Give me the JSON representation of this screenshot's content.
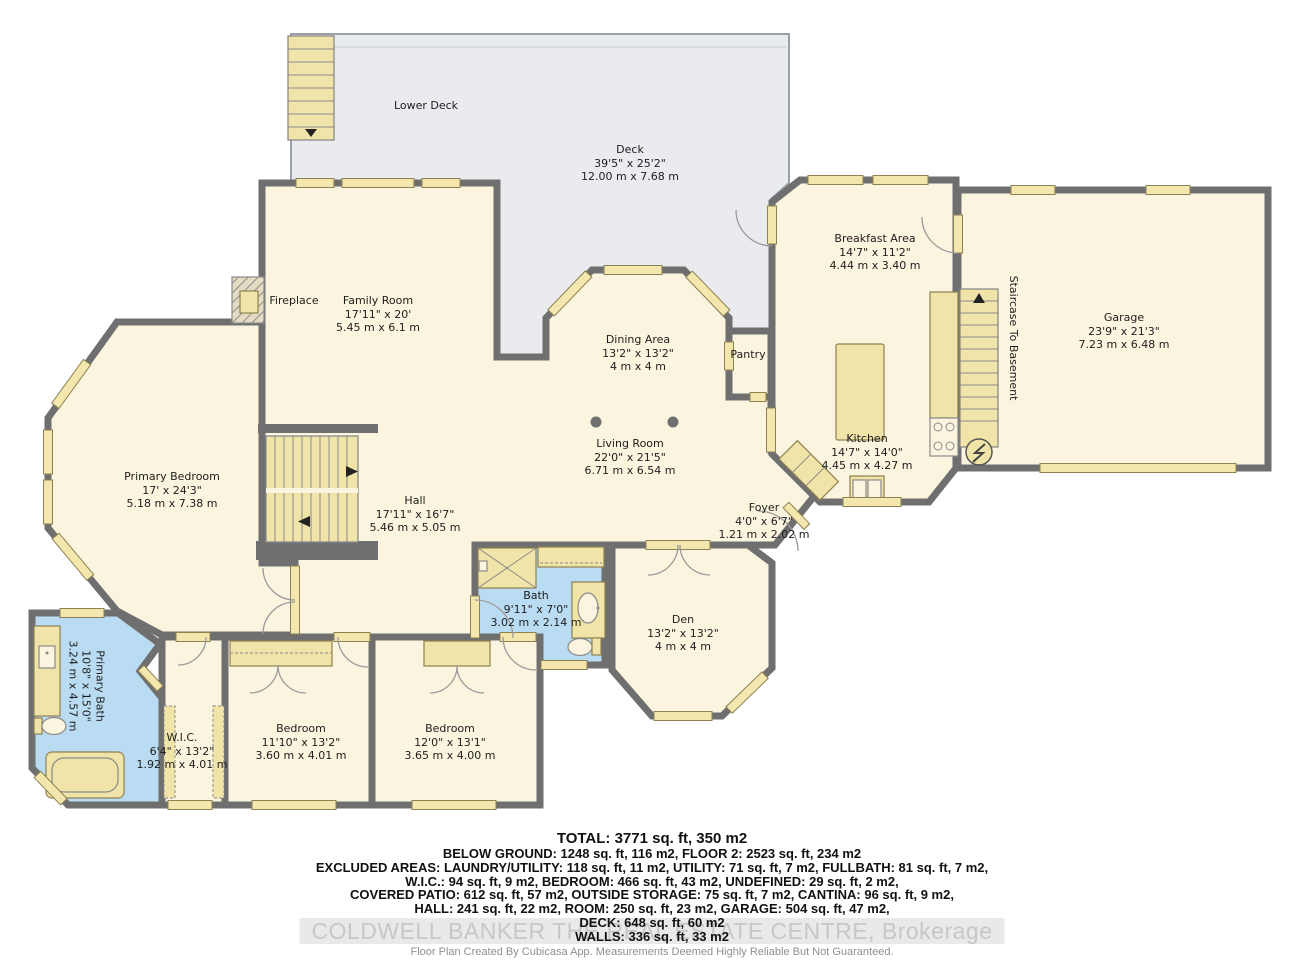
{
  "colors": {
    "wall": "#6f6f6f",
    "room_fill": "#fbf5df",
    "deck_fill": "#e9ebee",
    "bath_fill": "#badcf2",
    "fixture_fill": "#f1e4a8"
  },
  "rooms": {
    "lower_deck": {
      "name": "Lower Deck"
    },
    "deck": {
      "name": "Deck",
      "imperial": "39'5\" x 25'2\"",
      "metric": "12.00 m x 7.68 m"
    },
    "breakfast": {
      "name": "Breakfast Area",
      "imperial": "14'7\" x 11'2\"",
      "metric": "4.44 m x 3.40 m"
    },
    "garage": {
      "name": "Garage",
      "imperial": "23'9\" x 21'3\"",
      "metric": "7.23 m x 6.48 m"
    },
    "staircase_basement": {
      "name": "Staircase To Basement"
    },
    "kitchen": {
      "name": "Kitchen",
      "imperial": "14'7\" x 14'0\"",
      "metric": "4.45 m x 4.27 m"
    },
    "pantry": {
      "name": "Pantry"
    },
    "family": {
      "name": "Family Room",
      "imperial": "17'11\" x 20'",
      "metric": "5.45 m x 6.1 m"
    },
    "fireplace": {
      "name": "Fireplace"
    },
    "dining": {
      "name": "Dining Area",
      "imperial": "13'2\" x 13'2\"",
      "metric": "4 m x 4 m"
    },
    "living": {
      "name": "Living Room",
      "imperial": "22'0\" x 21'5\"",
      "metric": "6.71 m x 6.54 m"
    },
    "primary_bedroom": {
      "name": "Primary Bedroom",
      "imperial": "17' x 24'3\"",
      "metric": "5.18 m x 7.38 m"
    },
    "hall": {
      "name": "Hall",
      "imperial": "17'11\" x 16'7\"",
      "metric": "5.46 m x 5.05 m"
    },
    "foyer": {
      "name": "Foyer",
      "imperial": "4'0\" x 6'7\"",
      "metric": "1.21 m x 2.02 m"
    },
    "bath": {
      "name": "Bath",
      "imperial": "9'11\" x 7'0\"",
      "metric": "3.02 m x 2.14 m"
    },
    "den": {
      "name": "Den",
      "imperial": "13'2\" x 13'2\"",
      "metric": "4 m x 4 m"
    },
    "primary_bath": {
      "name": "Primary Bath",
      "imperial": "10'8\" x 15'0\"",
      "metric": "3.24 m x 4.57 m"
    },
    "wic": {
      "name": "W.I.C.",
      "imperial": "6'4\" x 13'2\"",
      "metric": "1.92 m x 4.01 m"
    },
    "bedroom1": {
      "name": "Bedroom",
      "imperial": "11'10\" x 13'2\"",
      "metric": "3.60 m x 4.01 m"
    },
    "bedroom2": {
      "name": "Bedroom",
      "imperial": "12'0\" x 13'1\"",
      "metric": "3.65 m x 4.00 m"
    }
  },
  "summary": {
    "total": "TOTAL: 3771 sq. ft, 350 m2",
    "lines": [
      "BELOW GROUND: 1248 sq. ft, 116 m2, FLOOR 2: 2523 sq. ft, 234 m2",
      "EXCLUDED AREAS: LAUNDRY/UTILITY: 118 sq. ft, 11 m2, UTILITY: 71 sq. ft, 7 m2, FULLBATH: 81 sq. ft, 7 m2,",
      "W.I.C.: 94 sq. ft, 9 m2, BEDROOM: 466 sq. ft, 43 m2, UNDEFINED: 29 sq. ft, 2 m2,",
      "COVERED PATIO: 612 sq. ft, 57 m2, OUTSIDE STORAGE: 75 sq. ft, 7 m2, CANTINA: 96 sq. ft, 9 m2,",
      "HALL: 241 sq. ft, 22 m2, ROOM: 250 sq. ft, 23 m2, GARAGE: 504 sq. ft, 47 m2,",
      "DECK: 648 sq. ft, 60 m2",
      "WALLS: 336 sq. ft, 33 m2"
    ],
    "watermark": "COLDWELL BANKER THE REAL ESTATE CENTRE, Brokerage",
    "disclaimer": "Floor Plan Created By Cubicasa App. Measurements Deemed Highly Reliable But Not Guaranteed."
  }
}
